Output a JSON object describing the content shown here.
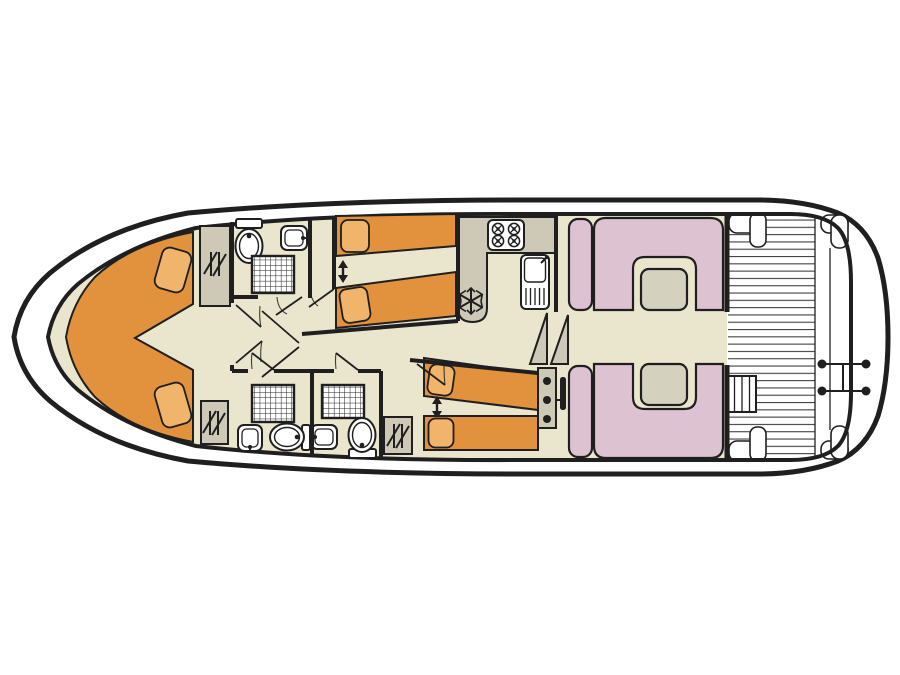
{
  "meta": {
    "title": "Houseboat deck plan",
    "view": "top-down floor plan",
    "bow": "left",
    "stern": "right"
  },
  "colors": {
    "line": "#1f1f1f",
    "hull": "#ffffff",
    "floor": "#eae5cd",
    "bed": "#e2913c",
    "pillow": "#f0b46a",
    "cabinet": "#cdc9b6",
    "seating": "#ddc3d2",
    "table": "#d4d1bf",
    "fixture": "#ffffff",
    "deck": "#ffffff",
    "plank": "#3f3f3f"
  },
  "icons": {
    "fridge": "snowflake",
    "wardrobe": "hanger-rail",
    "bed_adjust": "double-arrow",
    "stove": "four-burner-hob",
    "helm": "console-with-wheel"
  },
  "rooms": [
    {
      "name": "bow-cabin",
      "furniture": [
        "v-berth-double-bed",
        "pillow-port",
        "pillow-starboard",
        "wardrobe-top",
        "wardrobe-bottom"
      ]
    },
    {
      "name": "bathroom-forward",
      "furniture": [
        "toilet",
        "washbasin",
        "shower"
      ]
    },
    {
      "name": "cabin-top-middle",
      "furniture": [
        "single-bed",
        "single-bed",
        "slide-arrow"
      ]
    },
    {
      "name": "bathroom-bottom-left",
      "furniture": [
        "shower",
        "washbasin",
        "toilet"
      ]
    },
    {
      "name": "bathroom-bottom-middle",
      "furniture": [
        "shower",
        "washbasin",
        "toilet"
      ]
    },
    {
      "name": "cabin-bottom-aft",
      "furniture": [
        "single-bed",
        "single-bed",
        "slide-arrow",
        "wardrobe"
      ]
    },
    {
      "name": "galley",
      "furniture": [
        "l-counter",
        "stove-4-burners",
        "sink-with-drainer",
        "fridge"
      ]
    },
    {
      "name": "companionway",
      "furniture": [
        "steps",
        "helm-console",
        "steering-wheel"
      ]
    },
    {
      "name": "saloon",
      "furniture": [
        "u-bench-top",
        "table-top",
        "side-seat-top",
        "u-bench-bottom",
        "table-bottom",
        "side-seat-bottom"
      ]
    },
    {
      "name": "aft-deck",
      "furniture": [
        "plank-floor",
        "corner-seat-x4",
        "steps",
        "swim-ladder"
      ]
    }
  ]
}
